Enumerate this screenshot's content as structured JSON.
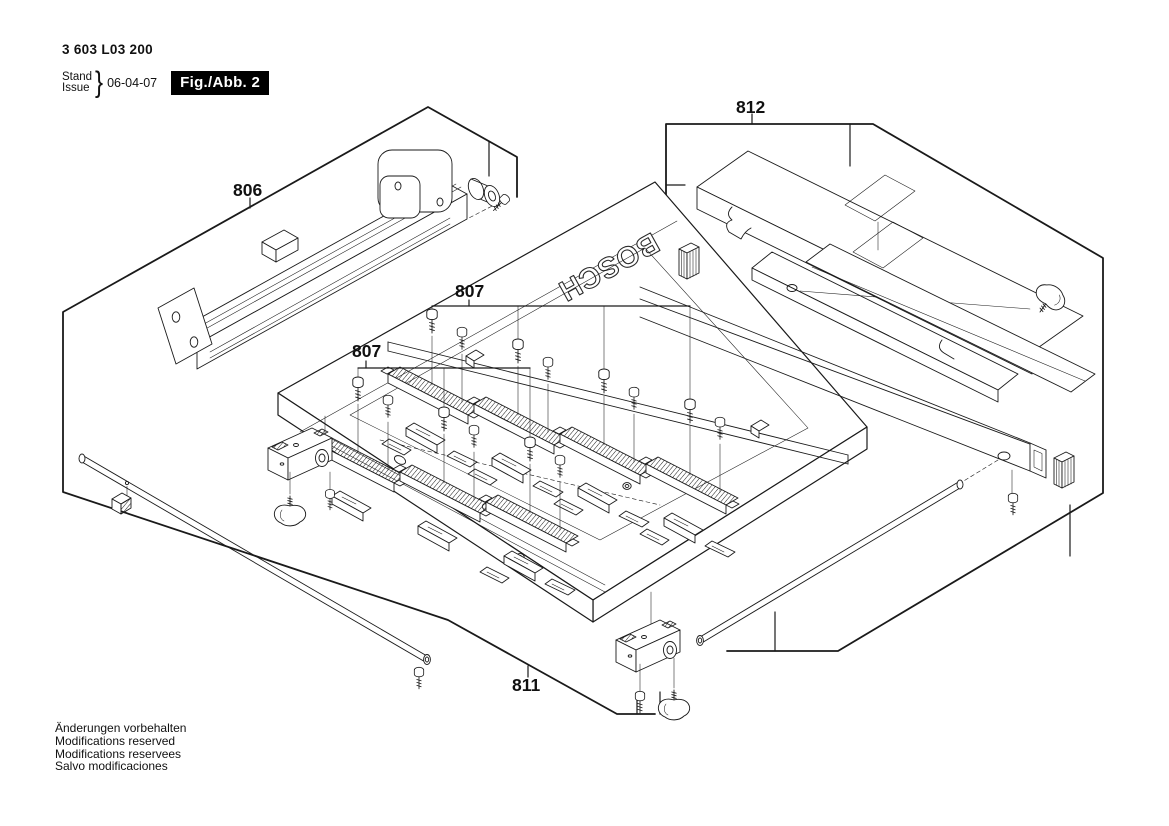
{
  "header": {
    "part_number": "3 603 L03 200",
    "stand": "Stand",
    "issue": "Issue",
    "brace": "}",
    "date": "06-04-07",
    "figure": "Fig./Abb. 2"
  },
  "footer": {
    "lines": [
      "Änderungen vorbehalten",
      "Modifications reserved",
      "Modifications reservees",
      "Salvo modificaciones"
    ]
  },
  "diagram": {
    "brand": "BOSCH",
    "callouts": [
      {
        "id": "806",
        "label": "806"
      },
      {
        "id": "807-upper",
        "label": "807"
      },
      {
        "id": "807-lower",
        "label": "807"
      },
      {
        "id": "811",
        "label": "811"
      },
      {
        "id": "812",
        "label": "812"
      }
    ]
  },
  "colors": {
    "line": "#1a1a1a",
    "background": "#ffffff",
    "figure_box_bg": "#000000",
    "figure_box_text": "#ffffff"
  }
}
